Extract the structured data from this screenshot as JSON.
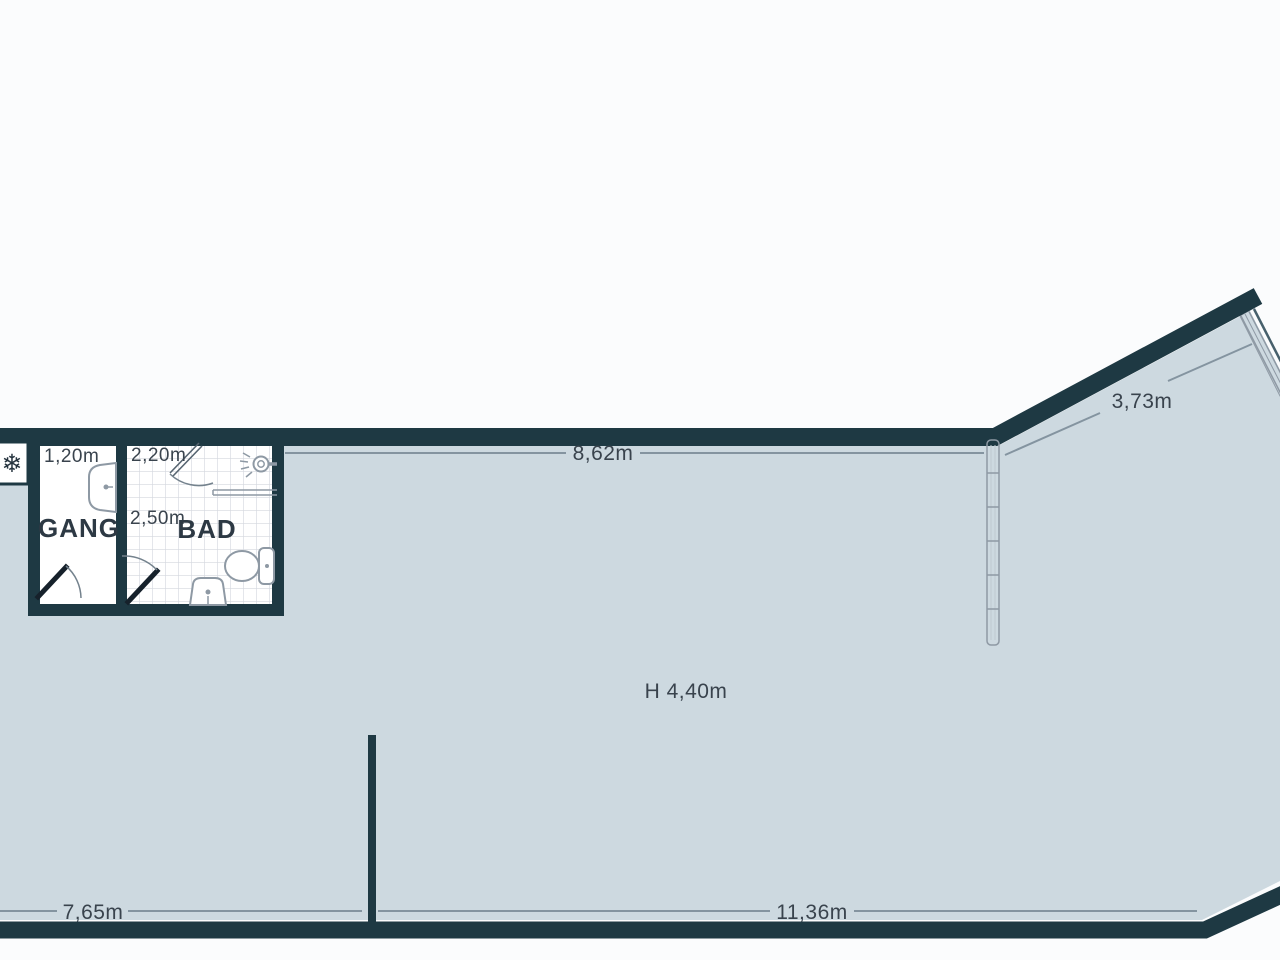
{
  "rooms": {
    "gang": {
      "name": "GANG",
      "width": "1,20m"
    },
    "bad": {
      "name": "BAD",
      "width": "2,20m",
      "depth": "2,50m"
    }
  },
  "dimensions": {
    "top_wall": "8,62m",
    "angled_wall": "3,73m",
    "ceiling_height": "H 4,40m",
    "bottom_left": "7,65m",
    "bottom_right": "11,36m"
  },
  "icons": {
    "snowflake_icon": "❄"
  },
  "colors": {
    "wall": "#1e3943",
    "floor": "#cdd9e0",
    "background": "#fbfcfd",
    "dimension_line": "#8494a0",
    "text": "#39434d",
    "room_text": "#2d3944",
    "tile_line": "#d3d7de",
    "fixture_line": "#8e99a4",
    "door_leaf": "#16212b",
    "window_line": "#8e99a4"
  }
}
